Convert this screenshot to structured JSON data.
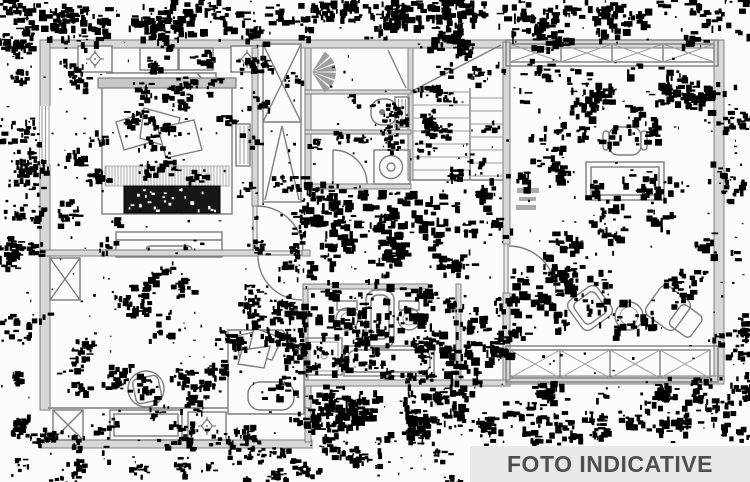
{
  "banner": {
    "label": "FOTO INDICATIVE"
  },
  "colors": {
    "background": "#fcfcfb",
    "line": "#7d7d7d",
    "wall_fill": "#d9d7d5",
    "noise": "#000000",
    "banner_bg": "#eae9e8",
    "banner_text": "#4e4e4e"
  }
}
